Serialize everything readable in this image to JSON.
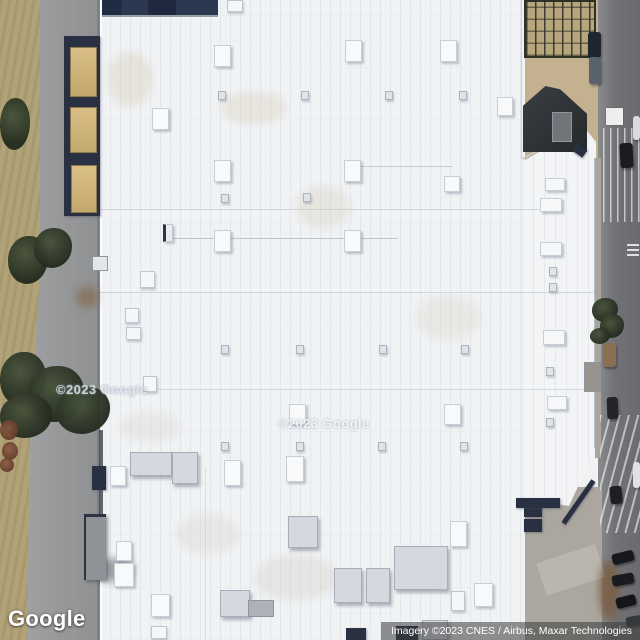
{
  "app": {
    "title": "Google Maps satellite imagery view"
  },
  "logo": {
    "text": "Google"
  },
  "attribution": {
    "text": "Imagery ©2023 CNES / Airbus, Maxar Technologies"
  },
  "watermarks": [
    {
      "text": "©2023 Google",
      "x": 56,
      "y": 382
    },
    {
      "text": "©2023 Google",
      "x": 278,
      "y": 416
    }
  ],
  "colors": {
    "roof_white": "#f0f2f4",
    "hvac_blue": "#4d5f92",
    "navy_edge": "#283041",
    "field_tan": "#b1a377",
    "road_gray": "#717275",
    "tree_green": "#2b331f",
    "attribution_bg": "rgba(58,58,58,0.55)"
  },
  "scene": {
    "objects": [
      {
        "cls": "stain",
        "n": "roof-stain",
        "x": 108,
        "y": 52,
        "w": 44,
        "h": 54,
        "bg": "rgba(202,184,146,.26)"
      },
      {
        "cls": "stain",
        "n": "roof-stain",
        "x": 222,
        "y": 92,
        "w": 64,
        "h": 32,
        "bg": "rgba(202,184,146,.22)"
      },
      {
        "cls": "stain",
        "n": "roof-stain",
        "x": 296,
        "y": 186,
        "w": 54,
        "h": 42,
        "bg": "rgba(200,184,152,.2)"
      },
      {
        "cls": "stain",
        "n": "roof-stain",
        "x": 416,
        "y": 296,
        "w": 64,
        "h": 44,
        "bg": "rgba(203,190,160,.18)"
      },
      {
        "cls": "stain",
        "n": "roof-stain",
        "x": 254,
        "y": 556,
        "w": 84,
        "h": 44,
        "bg": "rgba(192,182,162,.2)"
      },
      {
        "cls": "stain",
        "n": "roof-stain",
        "x": 176,
        "y": 514,
        "w": 64,
        "h": 40,
        "bg": "rgba(200,190,170,.2)"
      },
      {
        "cls": "stain",
        "n": "roof-stain",
        "x": 120,
        "y": 412,
        "w": 60,
        "h": 30,
        "bg": "rgba(200,190,168,.18)"
      },
      {
        "cls": "seam",
        "n": "roof-seam",
        "x": 100,
        "y": 209,
        "w": 458,
        "h": 1,
        "bg": "rgba(173,181,192,.45)"
      },
      {
        "cls": "seam",
        "n": "roof-seam",
        "x": 100,
        "y": 292,
        "w": 497,
        "h": 1,
        "bg": "rgba(173,181,192,.45)"
      },
      {
        "cls": "seam",
        "n": "roof-seam",
        "x": 100,
        "y": 389,
        "w": 492,
        "h": 1,
        "bg": "rgba(173,181,192,.4)"
      },
      {
        "cls": "seam",
        "n": "roof-seam",
        "x": 521,
        "y": 0,
        "w": 1,
        "h": 158,
        "bg": "rgba(173,181,192,.55)"
      },
      {
        "cls": "seam",
        "n": "roof-seam",
        "x": 205,
        "y": 468,
        "w": 1,
        "h": 172,
        "bg": "rgba(180,187,196,.35)"
      },
      {
        "cls": "seam",
        "n": "roof-pipe-line",
        "x": 170,
        "y": 238,
        "w": 228,
        "h": 1,
        "bg": "rgba(120,130,145,.4)"
      },
      {
        "cls": "seam",
        "n": "roof-pipe-line",
        "x": 352,
        "y": 166,
        "w": 100,
        "h": 1,
        "bg": "rgba(120,130,145,.35)"
      },
      {
        "cls": "seam",
        "n": "roof-edge-shadow",
        "x": 594,
        "y": 158,
        "w": 2,
        "h": 290,
        "bg": "rgba(148,156,168,.6)"
      },
      {
        "cls": "seam",
        "n": "building-edge-dark-segment",
        "x": 99,
        "y": 430,
        "w": 4,
        "h": 120,
        "bg": "rgba(58,65,80,.8)"
      },
      {
        "cls": "seam",
        "n": "roof-corner-edge",
        "x": 522,
        "y": 158,
        "w": 68,
        "h": 2,
        "bg": "#c3c8cf",
        "rot": -27.7,
        "origin": "left center"
      },
      {
        "cls": "navy",
        "n": "loading-dock-shadow",
        "x": 64,
        "y": 36,
        "w": 36,
        "h": 180
      },
      {
        "cls": "trailer",
        "n": "trailer",
        "x": 70,
        "y": 47,
        "w": 27,
        "h": 50
      },
      {
        "cls": "trailer",
        "n": "trailer",
        "x": 70,
        "y": 107,
        "w": 27,
        "h": 46
      },
      {
        "cls": "trailer",
        "n": "trailer",
        "x": 71,
        "y": 165,
        "w": 26,
        "h": 48
      },
      {
        "cls": "gray-box",
        "n": "utility-box",
        "x": 92,
        "y": 256,
        "w": 16,
        "h": 15,
        "bg": "#e4e6e8"
      },
      {
        "cls": "stain",
        "n": "dirt-patch",
        "x": 76,
        "y": 286,
        "w": 22,
        "h": 22,
        "bg": "rgba(128,96,62,.55)"
      },
      {
        "cls": "stain",
        "n": "road-smudge",
        "x": 96,
        "y": 558,
        "w": 38,
        "h": 24,
        "bg": "rgba(40,45,52,.4)"
      },
      {
        "cls": "navy",
        "n": "dock-structure",
        "x": 92,
        "y": 466,
        "w": 14,
        "h": 24
      },
      {
        "cls": "canopy",
        "n": "loading-canopy",
        "x": 84,
        "y": 514,
        "w": 22,
        "h": 66
      },
      {
        "cls": "tree",
        "n": "tree",
        "x": 0,
        "y": 98,
        "w": 30,
        "h": 52
      },
      {
        "cls": "tree",
        "n": "tree",
        "x": 8,
        "y": 236,
        "w": 40,
        "h": 48
      },
      {
        "cls": "tree",
        "n": "tree",
        "x": 34,
        "y": 228,
        "w": 38,
        "h": 40
      },
      {
        "cls": "tree",
        "n": "tree",
        "x": 0,
        "y": 352,
        "w": 46,
        "h": 54
      },
      {
        "cls": "tree",
        "n": "tree",
        "x": 28,
        "y": 366,
        "w": 56,
        "h": 56
      },
      {
        "cls": "tree",
        "n": "tree",
        "x": 56,
        "y": 386,
        "w": 54,
        "h": 48
      },
      {
        "cls": "tree",
        "n": "tree",
        "x": 0,
        "y": 394,
        "w": 52,
        "h": 44
      },
      {
        "cls": "bush",
        "n": "red-bush",
        "x": 0,
        "y": 420,
        "w": 18,
        "h": 20
      },
      {
        "cls": "bush",
        "n": "red-bush",
        "x": 2,
        "y": 442,
        "w": 16,
        "h": 18
      },
      {
        "cls": "bush",
        "n": "red-bush",
        "x": 0,
        "y": 458,
        "w": 14,
        "h": 14
      },
      {
        "cls": "framework",
        "n": "metal-framework-structure",
        "x": 524,
        "y": 0,
        "w": 72,
        "h": 58
      },
      {
        "cls": "dark-bldg",
        "n": "shadowed-peaked-building",
        "x": 523,
        "y": 86,
        "w": 64,
        "h": 66,
        "clip": "polygon(0 30%, 35% 0, 58% 5%, 100% 42%, 100% 100%, 0 100%)"
      },
      {
        "cls": "gray-box",
        "n": "building-roof-block",
        "x": 552,
        "y": 112,
        "w": 20,
        "h": 30,
        "bg": "#70757a"
      },
      {
        "cls": "car",
        "n": "truck-cab",
        "x": 588,
        "y": 32,
        "w": 13,
        "h": 26,
        "bg": "#20262e"
      },
      {
        "cls": "car",
        "n": "truck-trailer",
        "x": 589,
        "y": 57,
        "w": 12,
        "h": 27,
        "bg": "#5a626b"
      },
      {
        "cls": "seam",
        "n": "sidewalk-strip",
        "x": 595,
        "y": 158,
        "w": 6,
        "h": 300,
        "bg": "#a9a59e"
      },
      {
        "cls": "gray-box",
        "n": "sidewalk-block",
        "x": 584,
        "y": 362,
        "w": 17,
        "h": 30,
        "bg": "#96938c"
      },
      {
        "cls": "stripes-v",
        "n": "road-stripe-zone-north",
        "x": 603,
        "y": 128,
        "w": 37,
        "h": 94
      },
      {
        "cls": "mark",
        "n": "road-marking",
        "x": 606,
        "y": 108,
        "w": 17,
        "h": 17
      },
      {
        "cls": "mark2",
        "n": "road-marking-small",
        "x": 627,
        "y": 244,
        "w": 12,
        "h": 12
      },
      {
        "cls": "stripes-d",
        "n": "road-stripe-zone-south",
        "x": 600,
        "y": 415,
        "w": 40,
        "h": 118
      },
      {
        "cls": "seam",
        "n": "pavement-path",
        "x": 540,
        "y": 553,
        "w": 62,
        "h": 34,
        "bg": "rgba(205,200,190,.45)",
        "rot": -18
      },
      {
        "cls": "stain",
        "n": "dirt-patch-parking",
        "x": 599,
        "y": 560,
        "w": 20,
        "h": 60,
        "bg": "rgba(122,92,62,.8)"
      },
      {
        "cls": "tree",
        "n": "tree",
        "x": 592,
        "y": 298,
        "w": 26,
        "h": 24
      },
      {
        "cls": "tree",
        "n": "tree",
        "x": 600,
        "y": 314,
        "w": 24,
        "h": 24
      },
      {
        "cls": "tree",
        "n": "tree",
        "x": 590,
        "y": 328,
        "w": 20,
        "h": 16
      },
      {
        "cls": "car",
        "n": "car",
        "x": 620,
        "y": 143,
        "w": 13,
        "h": 25,
        "bg": "#1a1c1f",
        "rot": -3
      },
      {
        "cls": "car",
        "n": "car",
        "x": 633,
        "y": 116,
        "w": 7,
        "h": 24,
        "bg": "#d9dadb"
      },
      {
        "cls": "car",
        "n": "truck-brown",
        "x": 603,
        "y": 343,
        "w": 13,
        "h": 24,
        "bg": "#8b6f52"
      },
      {
        "cls": "car",
        "n": "car",
        "x": 607,
        "y": 397,
        "w": 11,
        "h": 22,
        "bg": "#232528",
        "rot": -2
      },
      {
        "cls": "car",
        "n": "car",
        "x": 610,
        "y": 486,
        "w": 12,
        "h": 18,
        "bg": "#1d1f22",
        "rot": -6
      },
      {
        "cls": "car",
        "n": "car",
        "x": 633,
        "y": 462,
        "w": 7,
        "h": 26,
        "bg": "#e0e1e2"
      },
      {
        "cls": "car",
        "n": "parked-car",
        "x": 612,
        "y": 552,
        "w": 22,
        "h": 11,
        "bg": "#16181b",
        "rot": -14
      },
      {
        "cls": "car",
        "n": "parked-car",
        "x": 612,
        "y": 574,
        "w": 22,
        "h": 11,
        "bg": "#191b1e",
        "rot": -10
      },
      {
        "cls": "car",
        "n": "parked-car",
        "x": 616,
        "y": 596,
        "w": 20,
        "h": 11,
        "bg": "#141618",
        "rot": -14
      },
      {
        "cls": "car",
        "n": "parked-car",
        "x": 626,
        "y": 616,
        "w": 16,
        "h": 10,
        "bg": "#35383b",
        "rot": -10
      },
      {
        "cls": "navy",
        "n": "dumpster",
        "x": 524,
        "y": 504,
        "w": 18,
        "h": 13
      },
      {
        "cls": "navy",
        "n": "dumpster",
        "x": 524,
        "y": 519,
        "w": 18,
        "h": 13
      },
      {
        "cls": "navy",
        "n": "roof-corner-unit",
        "x": 574,
        "y": 146,
        "w": 12,
        "h": 9,
        "rot": 35
      },
      {
        "cls": "navy",
        "n": "roof-edge-strip",
        "x": 516,
        "y": 498,
        "w": 44,
        "h": 10
      },
      {
        "cls": "navy",
        "n": "roof-edge-diagonal",
        "x": 576,
        "y": 476,
        "w": 5,
        "h": 52,
        "rot": 35
      },
      {
        "cls": "ac-top",
        "n": "hvac-unit",
        "x": 227,
        "y": 0,
        "w": 16,
        "h": 12
      },
      {
        "cls": "ac-lg",
        "n": "hvac-unit",
        "x": 214,
        "y": 45,
        "w": 17,
        "h": 22
      },
      {
        "cls": "ac-lg",
        "n": "hvac-unit",
        "x": 345,
        "y": 40,
        "w": 17,
        "h": 22
      },
      {
        "cls": "ac-lg",
        "n": "hvac-unit",
        "x": 440,
        "y": 40,
        "w": 17,
        "h": 22
      },
      {
        "cls": "ac-lg",
        "n": "hvac-unit",
        "x": 152,
        "y": 108,
        "w": 17,
        "h": 22
      },
      {
        "cls": "ac-lg",
        "n": "hvac-unit",
        "x": 497,
        "y": 97,
        "w": 16,
        "h": 19
      },
      {
        "cls": "ac-sm",
        "n": "roof-vent",
        "x": 218,
        "y": 91,
        "w": 8,
        "h": 9
      },
      {
        "cls": "ac-sm",
        "n": "roof-vent",
        "x": 301,
        "y": 91,
        "w": 8,
        "h": 9
      },
      {
        "cls": "ac-sm",
        "n": "roof-vent",
        "x": 385,
        "y": 91,
        "w": 8,
        "h": 9
      },
      {
        "cls": "ac-sm",
        "n": "roof-vent",
        "x": 459,
        "y": 91,
        "w": 8,
        "h": 9
      },
      {
        "cls": "ac-lg",
        "n": "hvac-unit",
        "x": 214,
        "y": 160,
        "w": 17,
        "h": 22
      },
      {
        "cls": "ac-lg",
        "n": "hvac-unit",
        "x": 344,
        "y": 160,
        "w": 17,
        "h": 22
      },
      {
        "cls": "ac-lg",
        "n": "hvac-unit",
        "x": 444,
        "y": 176,
        "w": 16,
        "h": 16
      },
      {
        "cls": "ac-sm",
        "n": "roof-vent",
        "x": 221,
        "y": 194,
        "w": 8,
        "h": 9
      },
      {
        "cls": "ac-sm",
        "n": "roof-vent",
        "x": 303,
        "y": 193,
        "w": 8,
        "h": 9
      },
      {
        "cls": "duct",
        "n": "roof-duct",
        "x": 163,
        "y": 224,
        "w": 10,
        "h": 18
      },
      {
        "cls": "ac-lg",
        "n": "hvac-unit",
        "x": 214,
        "y": 230,
        "w": 17,
        "h": 22
      },
      {
        "cls": "ac-lg",
        "n": "hvac-unit",
        "x": 344,
        "y": 230,
        "w": 17,
        "h": 22
      },
      {
        "cls": "ac-top",
        "n": "hvac-unit",
        "x": 140,
        "y": 271,
        "w": 15,
        "h": 17
      },
      {
        "cls": "ac-top",
        "n": "hvac-unit",
        "x": 125,
        "y": 308,
        "w": 14,
        "h": 15
      },
      {
        "cls": "ac-top",
        "n": "hvac-unit",
        "x": 126,
        "y": 327,
        "w": 15,
        "h": 13
      },
      {
        "cls": "ac-top",
        "n": "hvac-unit",
        "x": 143,
        "y": 376,
        "w": 14,
        "h": 16
      },
      {
        "cls": "ac-lgh",
        "n": "hvac-unit",
        "x": 545,
        "y": 178,
        "w": 20,
        "h": 13
      },
      {
        "cls": "ac-lgh",
        "n": "hvac-unit",
        "x": 540,
        "y": 198,
        "w": 22,
        "h": 14
      },
      {
        "cls": "ac-lgh",
        "n": "hvac-unit",
        "x": 540,
        "y": 242,
        "w": 22,
        "h": 14
      },
      {
        "cls": "ac-sm",
        "n": "roof-vent",
        "x": 549,
        "y": 267,
        "w": 8,
        "h": 9
      },
      {
        "cls": "ac-sm",
        "n": "roof-vent",
        "x": 549,
        "y": 283,
        "w": 8,
        "h": 9
      },
      {
        "cls": "ac-lgh",
        "n": "hvac-unit",
        "x": 543,
        "y": 330,
        "w": 22,
        "h": 15
      },
      {
        "cls": "ac-sm",
        "n": "roof-vent",
        "x": 546,
        "y": 367,
        "w": 8,
        "h": 9
      },
      {
        "cls": "ac-lgh",
        "n": "hvac-unit",
        "x": 547,
        "y": 396,
        "w": 20,
        "h": 14
      },
      {
        "cls": "ac-sm",
        "n": "roof-vent",
        "x": 546,
        "y": 418,
        "w": 8,
        "h": 9
      },
      {
        "cls": "ac-sm",
        "n": "roof-vent",
        "x": 221,
        "y": 345,
        "w": 8,
        "h": 9
      },
      {
        "cls": "ac-sm",
        "n": "roof-vent",
        "x": 296,
        "y": 345,
        "w": 8,
        "h": 9
      },
      {
        "cls": "ac-sm",
        "n": "roof-vent",
        "x": 379,
        "y": 345,
        "w": 8,
        "h": 9
      },
      {
        "cls": "ac-sm",
        "n": "roof-vent",
        "x": 461,
        "y": 345,
        "w": 8,
        "h": 9
      },
      {
        "cls": "ac-lg",
        "n": "hvac-unit",
        "x": 289,
        "y": 404,
        "w": 17,
        "h": 21
      },
      {
        "cls": "ac-lg",
        "n": "hvac-unit",
        "x": 444,
        "y": 404,
        "w": 17,
        "h": 21
      },
      {
        "cls": "ac-sm",
        "n": "roof-vent",
        "x": 221,
        "y": 442,
        "w": 8,
        "h": 9
      },
      {
        "cls": "ac-sm",
        "n": "roof-vent",
        "x": 296,
        "y": 442,
        "w": 8,
        "h": 9
      },
      {
        "cls": "ac-sm",
        "n": "roof-vent",
        "x": 378,
        "y": 442,
        "w": 8,
        "h": 9
      },
      {
        "cls": "ac-sm",
        "n": "roof-vent",
        "x": 460,
        "y": 442,
        "w": 8,
        "h": 9
      },
      {
        "cls": "ac-xl",
        "n": "hvac-unit-large",
        "x": 130,
        "y": 452,
        "w": 42,
        "h": 24
      },
      {
        "cls": "ac-xl",
        "n": "hvac-unit-large",
        "x": 172,
        "y": 452,
        "w": 26,
        "h": 32
      },
      {
        "cls": "ac-lg",
        "n": "hvac-unit",
        "x": 110,
        "y": 466,
        "w": 16,
        "h": 20
      },
      {
        "cls": "ac-lg",
        "n": "hvac-unit",
        "x": 224,
        "y": 460,
        "w": 17,
        "h": 26
      },
      {
        "cls": "ac-lg",
        "n": "hvac-unit",
        "x": 286,
        "y": 456,
        "w": 18,
        "h": 26
      },
      {
        "cls": "ac-xl",
        "n": "hvac-unit-large",
        "x": 288,
        "y": 516,
        "w": 30,
        "h": 32
      },
      {
        "cls": "ac-lg",
        "n": "hvac-unit",
        "x": 116,
        "y": 541,
        "w": 16,
        "h": 20
      },
      {
        "cls": "ac-lg",
        "n": "hvac-unit",
        "x": 114,
        "y": 563,
        "w": 20,
        "h": 24
      },
      {
        "cls": "ac-lg",
        "n": "hvac-unit",
        "x": 151,
        "y": 594,
        "w": 19,
        "h": 23
      },
      {
        "cls": "ac-xl",
        "n": "hvac-unit-large",
        "x": 220,
        "y": 590,
        "w": 30,
        "h": 27
      },
      {
        "cls": "gray-box",
        "n": "hvac-gray-extension",
        "x": 248,
        "y": 600,
        "w": 26,
        "h": 17
      },
      {
        "cls": "ac-xl",
        "n": "hvac-unit-large",
        "x": 334,
        "y": 568,
        "w": 28,
        "h": 35
      },
      {
        "cls": "ac-xl",
        "n": "hvac-unit-large",
        "x": 366,
        "y": 568,
        "w": 24,
        "h": 35
      },
      {
        "cls": "ac-xl",
        "n": "hvac-unit-large",
        "x": 394,
        "y": 546,
        "w": 54,
        "h": 44
      },
      {
        "cls": "ac-lg",
        "n": "hvac-unit",
        "x": 450,
        "y": 521,
        "w": 17,
        "h": 26
      },
      {
        "cls": "ac-lg",
        "n": "hvac-unit",
        "x": 474,
        "y": 583,
        "w": 19,
        "h": 24
      },
      {
        "cls": "ac-top",
        "n": "hvac-unit",
        "x": 451,
        "y": 591,
        "w": 14,
        "h": 20
      },
      {
        "cls": "ac-top",
        "n": "hvac-unit",
        "x": 151,
        "y": 626,
        "w": 16,
        "h": 13
      },
      {
        "cls": "navy",
        "n": "hvac-unit-dark",
        "x": 346,
        "y": 628,
        "w": 20,
        "h": 12
      },
      {
        "cls": "navy",
        "n": "hvac-unit-dark",
        "x": 396,
        "y": 626,
        "w": 22,
        "h": 14
      },
      {
        "cls": "ac-xl",
        "n": "hvac-unit-large",
        "x": 422,
        "y": 620,
        "w": 26,
        "h": 20
      }
    ]
  }
}
